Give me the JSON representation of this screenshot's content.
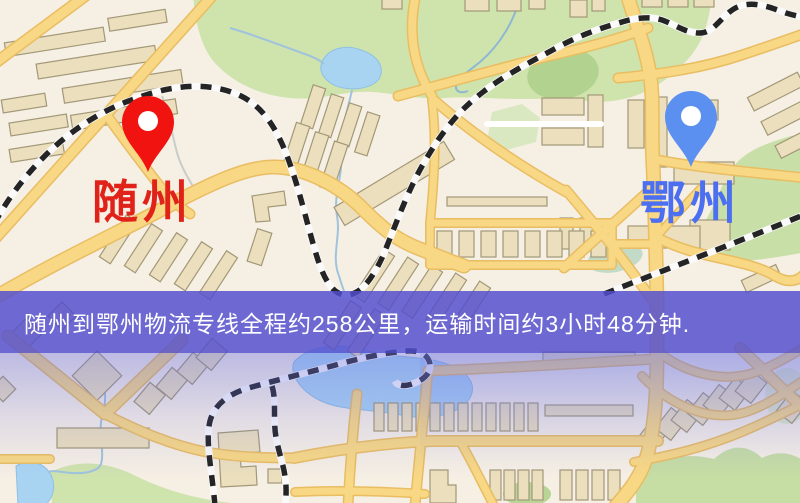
{
  "map": {
    "origin": {
      "name": "随州",
      "pin_color": "#f01310",
      "label_color": "#e02219"
    },
    "destination": {
      "name": "鄂州",
      "pin_color": "#5b90f0",
      "label_color": "#4b6ff0"
    },
    "banner": {
      "text": "随州到鄂州物流专线全程约258公里，运输时间约3小时48分钟.",
      "background_color": "#544fce",
      "text_color": "#ffffff"
    },
    "route": {
      "distance_text": "约258公里",
      "duration_text": "约3小时48分钟"
    },
    "palette": {
      "background": "#f6efe4",
      "road_fill": "#f8d884",
      "road_casing": "#e9bd62",
      "park_green": "#cfe3ad",
      "water_blue": "#a9d4f1",
      "building_fill": "#ebdfbd",
      "building_stroke": "#a29877",
      "railway_dark": "#242424"
    }
  }
}
